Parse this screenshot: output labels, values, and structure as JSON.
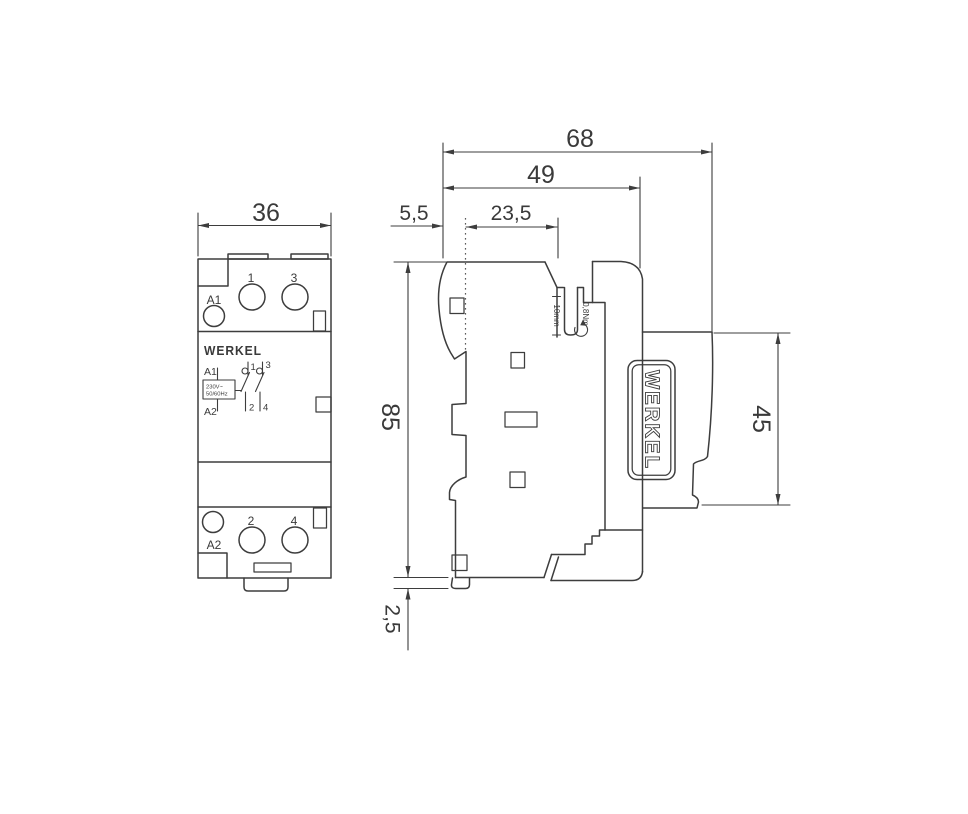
{
  "front": {
    "dim_width": "36",
    "terminal_1": "1",
    "terminal_3": "3",
    "terminal_2": "2",
    "terminal_4": "4",
    "coil_a1": "A1",
    "coil_a2": "A2",
    "brand": "WERKEL",
    "schematic": {
      "a1": "A1",
      "a2": "A2",
      "rating_line1": "230V~",
      "rating_line2": "50/60Hz",
      "c1": "1",
      "c2": "2",
      "c3": "3",
      "c4": "4"
    }
  },
  "side": {
    "dim_total_depth": "68",
    "dim_body_depth": "49",
    "dim_front_lip": "5,5",
    "dim_top_flat": "23,5",
    "dim_height": "85",
    "dim_rail_clip": "2,5",
    "dim_din_window": "45",
    "strip_length": "10mm",
    "tightening_torque": "0,8Nm",
    "brand": "WERKEL"
  },
  "colors": {
    "line": "#3d3d3d",
    "brand_gold": "#8d7354",
    "background": "#ffffff"
  }
}
